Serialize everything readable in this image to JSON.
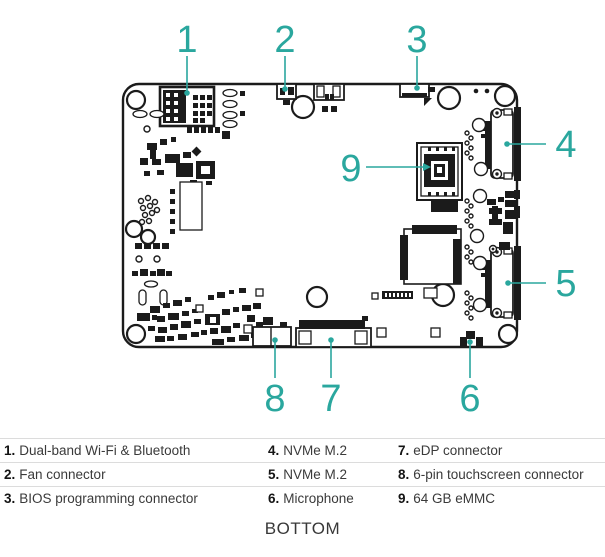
{
  "colors": {
    "accent": "#2aa79e",
    "ink": "#1b1b1b",
    "text": "#3a3a3a",
    "divider": "#dcdcdc"
  },
  "callouts": [
    "1",
    "2",
    "3",
    "4",
    "5",
    "6",
    "7",
    "8",
    "9"
  ],
  "legend": {
    "rows": [
      {
        "cells": [
          {
            "num": "1.",
            "label": "Dual-band Wi-Fi & Bluetooth"
          },
          {
            "num": "4.",
            "label": "NVMe M.2"
          },
          {
            "num": "7.",
            "label": "eDP connector"
          }
        ]
      },
      {
        "cells": [
          {
            "num": "2.",
            "label": "Fan connector"
          },
          {
            "num": "5.",
            "label": "NVMe M.2"
          },
          {
            "num": "8.",
            "label": "6-pin touchscreen connector"
          }
        ]
      },
      {
        "cells": [
          {
            "num": "3.",
            "label": "BIOS programming connector"
          },
          {
            "num": "6.",
            "label": "Microphone"
          },
          {
            "num": "9.",
            "label": "64 GB eMMC"
          }
        ]
      }
    ]
  },
  "footer": {
    "view_label": "BOTTOM"
  }
}
